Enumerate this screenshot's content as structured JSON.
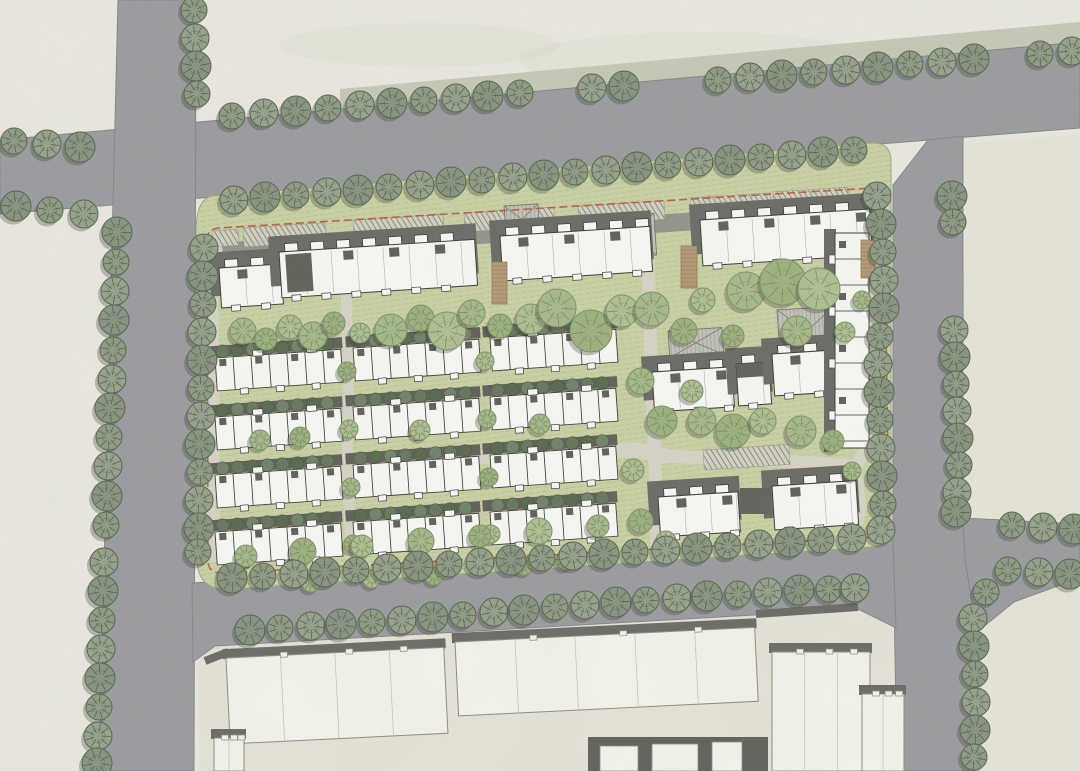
{
  "meta": {
    "title": "Residential site plan rendering",
    "canvas": {
      "w": 1080,
      "h": 771
    }
  },
  "palette": {
    "paper": "#edebe2",
    "verge": "#c2c5b1",
    "parcel": "#e9e6d9",
    "parcelRight": "#eae7da",
    "road": "#9c9da1",
    "roadEdge": "#85868a",
    "lawn": "#ccd4a6",
    "lawnEdge": "#9aa77e",
    "lawnHatch": "#a9b77e",
    "innerLight": "#d9d6c8",
    "innerGray": "#96958c",
    "red": "#c0523c",
    "white": "#fbfbf8",
    "line": "#3a3a38",
    "shadow": "#6b6b66",
    "rowShadow": "#61615a",
    "darkUnit": "#5f6158",
    "darkBlock": "#62625c",
    "outlineFill": "#f7f6ef",
    "outlineLine": "#8e8e84",
    "gableFill": "#c4c3ba",
    "gableLine": "#6f6f68",
    "tan": "#b79b74",
    "tanLine": "#8a7452",
    "parkFill": "#d6d4c6",
    "parkLine": "#82857b",
    "blotch": "#8a9478"
  },
  "roads": {
    "top": [
      [
        0,
        140
      ],
      [
        1080,
        42
      ],
      [
        1080,
        128
      ],
      [
        0,
        214
      ]
    ],
    "left": [
      [
        118,
        0
      ],
      [
        196,
        0
      ],
      [
        194,
        771
      ],
      [
        99,
        771
      ]
    ],
    "right": [
      [
        893,
        185
      ],
      [
        928,
        140
      ],
      [
        963,
        136
      ],
      [
        963,
        515
      ],
      [
        977,
        640
      ],
      [
        975,
        771
      ],
      [
        897,
        771
      ],
      [
        893,
        545
      ]
    ],
    "eastSt": [
      [
        963,
        518
      ],
      [
        1080,
        524
      ],
      [
        1080,
        578
      ],
      [
        1014,
        602
      ],
      [
        977,
        632
      ],
      [
        965,
        560
      ]
    ],
    "bottom": [
      [
        192,
        583
      ],
      [
        870,
        542
      ],
      [
        893,
        540
      ],
      [
        896,
        628
      ],
      [
        858,
        609
      ],
      [
        215,
        646
      ],
      [
        193,
        662
      ]
    ]
  },
  "verge": [
    [
      340,
      89
    ],
    [
      1080,
      22
    ],
    [
      1080,
      44
    ],
    [
      340,
      111
    ]
  ],
  "parcels": [
    {
      "name": "block-northeast",
      "d": "M965,144 L1080,134 L1080,524 L996,524 Q965,524 965,493 Z",
      "fill": "parcelRight"
    },
    {
      "name": "block-southeast",
      "d": "M977,771 L977,650 Q977,612 1014,604 L1080,578 L1080,771 Z",
      "fill": "parcelRight"
    },
    {
      "name": "block-south",
      "d": "M200,771 L197,667 Q196,648 216,646 L850,608 Q886,604 893,628 L897,771 Z",
      "fill": "parcel"
    }
  ],
  "site": {
    "lawn": "M212,196 L872,143 Q891,142 891,162 L891,527 Q891,545 872,547 L232,589 Q198,592 197,560 L196,232 Q196,199 212,196 Z",
    "boundary": "M207,240 Q207,229 219,228 L872,188 Q884,187 884,197 L889,524 Q889,535 877,537 L224,573 Q209,574 208,562 Z",
    "boundaryDash": "8 4"
  },
  "innerRoads": [
    {
      "pts": [
        [
          214,
          252
        ],
        [
          870,
          210
        ]
      ],
      "w": 18,
      "c": "gray"
    },
    {
      "pts": [
        [
          216,
          250
        ],
        [
          212,
          300
        ],
        [
          214,
          556
        ]
      ],
      "w": 13,
      "c": "light"
    },
    {
      "pts": [
        [
          206,
          470
        ],
        [
          636,
          450
        ],
        [
          666,
          456
        ]
      ],
      "w": 15,
      "c": "light"
    },
    {
      "pts": [
        [
          345,
          258
        ],
        [
          349,
          402
        ],
        [
          347,
          448
        ],
        [
          351,
          556
        ]
      ],
      "w": 11,
      "c": "light"
    },
    {
      "pts": [
        [
          648,
          253
        ],
        [
          652,
          402
        ],
        [
          655,
          453
        ],
        [
          657,
          553
        ]
      ],
      "w": 13,
      "c": "light"
    },
    {
      "pts": [
        [
          870,
          219
        ],
        [
          876,
          340
        ],
        [
          876,
          430
        ],
        [
          856,
          466
        ],
        [
          800,
          462
        ],
        [
          666,
          456
        ]
      ],
      "w": 13,
      "c": "light"
    },
    {
      "pts": [
        [
          856,
          466
        ],
        [
          862,
          508
        ],
        [
          851,
          548
        ]
      ],
      "w": 10,
      "c": "light"
    }
  ],
  "parking": {
    "rot": -3.7,
    "strips": [
      [
        212,
        231,
        26,
        16
      ],
      [
        243,
        228,
        82,
        19
      ],
      [
        353,
        220,
        90,
        19
      ],
      [
        464,
        213,
        90,
        19
      ],
      [
        578,
        206,
        86,
        19
      ],
      [
        690,
        198,
        80,
        18
      ],
      [
        773,
        192,
        75,
        18
      ],
      [
        703,
        450,
        86,
        20
      ]
    ]
  },
  "pergolas": [
    [
      492,
      262,
      15,
      42
    ],
    [
      681,
      246,
      16,
      42
    ],
    [
      861,
      240,
      14,
      38
    ]
  ],
  "gables": {
    "rot": -3.7,
    "list": [
      [
        777,
        310,
        57,
        46
      ],
      [
        668,
        331,
        54,
        27
      ],
      [
        609,
        216,
        45,
        42
      ],
      [
        504,
        206,
        34,
        29
      ]
    ]
  },
  "slabs": [
    {
      "x": 219,
      "y": 268,
      "w": 62,
      "h": 40,
      "rot": -3.7
    },
    {
      "x": 279,
      "y": 252,
      "w": 196,
      "h": 46,
      "rot": -3.7,
      "darkEnd": true
    },
    {
      "x": 500,
      "y": 236,
      "w": 150,
      "h": 45,
      "rot": -3.7
    },
    {
      "x": 700,
      "y": 220,
      "w": 170,
      "h": 46,
      "rot": -3.7
    }
  ],
  "blocks": [
    {
      "x": 652,
      "y": 372,
      "w": 80,
      "h": 40,
      "rot": -3.7
    },
    {
      "x": 736,
      "y": 364,
      "w": 33,
      "h": 42,
      "rot": -3.7,
      "darkTop": true
    },
    {
      "x": 772,
      "y": 354,
      "w": 80,
      "h": 42,
      "rot": -3.7
    },
    {
      "x": 658,
      "y": 497,
      "w": 80,
      "h": 40,
      "rot": -3.7
    },
    {
      "x": 772,
      "y": 486,
      "w": 84,
      "h": 44,
      "rot": -3.7
    }
  ],
  "connector": {
    "x": 740,
    "y": 488,
    "w": 31,
    "h": 26
  },
  "strip": {
    "x": 835,
    "y": 233,
    "w": 34,
    "h": 215
  },
  "rows": {
    "w": 126,
    "h": 33,
    "rot": -4,
    "cols": [
      {
        "x": 215,
        "ys": [
          358,
          417,
          475,
          532
        ]
      },
      {
        "x": 353,
        "ys": [
          348,
          407,
          465,
          522
        ]
      },
      {
        "x": 490,
        "ys": [
          338,
          397,
          455,
          512
        ]
      }
    ]
  },
  "outlines": [
    {
      "x": 226,
      "y": 658,
      "w": 218,
      "h": 86,
      "rot": -2.8,
      "steps": 3
    },
    {
      "x": 455,
      "y": 642,
      "w": 300,
      "h": 74,
      "rot": -2.8,
      "steps": 4
    },
    {
      "x": 772,
      "y": 652,
      "w": 98,
      "h": 119,
      "rot": 0,
      "steps": 2
    },
    {
      "x": 214,
      "y": 738,
      "w": 30,
      "h": 33,
      "rot": 0,
      "steps": 1
    },
    {
      "x": 862,
      "y": 694,
      "w": 42,
      "h": 77,
      "rot": 0,
      "steps": 1
    }
  ],
  "darkBlock": {
    "x": 588,
    "y": 737,
    "w": 180,
    "h": 34,
    "insets": [
      [
        600,
        746,
        38,
        25
      ],
      [
        652,
        744,
        46,
        27
      ],
      [
        712,
        742,
        30,
        29
      ]
    ]
  },
  "walls": [
    [
      [
        205,
        661
      ],
      [
        228,
        652
      ]
    ],
    [
      [
        756,
        614
      ],
      [
        858,
        607
      ]
    ]
  ],
  "trees": {
    "street": [
      [
        14,
        141
      ],
      [
        47,
        144
      ],
      [
        80,
        147
      ],
      [
        232,
        116
      ],
      [
        264,
        113
      ],
      [
        296,
        111
      ],
      [
        328,
        108
      ],
      [
        360,
        105
      ],
      [
        392,
        103
      ],
      [
        424,
        100
      ],
      [
        456,
        98
      ],
      [
        488,
        96
      ],
      [
        520,
        93
      ],
      [
        592,
        88
      ],
      [
        624,
        86
      ],
      [
        718,
        80
      ],
      [
        750,
        77
      ],
      [
        782,
        75
      ],
      [
        814,
        72
      ],
      [
        846,
        70
      ],
      [
        878,
        67
      ],
      [
        910,
        64
      ],
      [
        942,
        62
      ],
      [
        974,
        59
      ],
      [
        1040,
        54
      ],
      [
        1072,
        51
      ],
      [
        16,
        206
      ],
      [
        50,
        210
      ],
      [
        84,
        214
      ],
      [
        117,
        232
      ],
      [
        116,
        262
      ],
      [
        115,
        291
      ],
      [
        114,
        320
      ],
      [
        113,
        350
      ],
      [
        112,
        379
      ],
      [
        110,
        408
      ],
      [
        109,
        437
      ],
      [
        108,
        466
      ],
      [
        107,
        496
      ],
      [
        106,
        525
      ],
      [
        104,
        562
      ],
      [
        103,
        591
      ],
      [
        102,
        620
      ],
      [
        101,
        649
      ],
      [
        100,
        678
      ],
      [
        99,
        707
      ],
      [
        98,
        736
      ],
      [
        97,
        763
      ],
      [
        194,
        10
      ],
      [
        195,
        38
      ],
      [
        196,
        66
      ],
      [
        197,
        94
      ],
      [
        234,
        200
      ],
      [
        265,
        197
      ],
      [
        296,
        195
      ],
      [
        327,
        192
      ],
      [
        358,
        190
      ],
      [
        389,
        187
      ],
      [
        420,
        185
      ],
      [
        451,
        182
      ],
      [
        482,
        180
      ],
      [
        513,
        177
      ],
      [
        544,
        175
      ],
      [
        575,
        172
      ],
      [
        606,
        170
      ],
      [
        637,
        167
      ],
      [
        668,
        165
      ],
      [
        699,
        162
      ],
      [
        730,
        160
      ],
      [
        761,
        157
      ],
      [
        792,
        155
      ],
      [
        823,
        152
      ],
      [
        854,
        150
      ],
      [
        204,
        248
      ],
      [
        203,
        276
      ],
      [
        203,
        304
      ],
      [
        202,
        332
      ],
      [
        202,
        360
      ],
      [
        201,
        388
      ],
      [
        201,
        416
      ],
      [
        200,
        444
      ],
      [
        200,
        472
      ],
      [
        199,
        500
      ],
      [
        199,
        528
      ],
      [
        198,
        552
      ],
      [
        877,
        196
      ],
      [
        881,
        224
      ],
      [
        883,
        252
      ],
      [
        884,
        280
      ],
      [
        884,
        308
      ],
      [
        880,
        336
      ],
      [
        878,
        364
      ],
      [
        879,
        392
      ],
      [
        880,
        420
      ],
      [
        881,
        448
      ],
      [
        882,
        476
      ],
      [
        883,
        504
      ],
      [
        881,
        530
      ],
      [
        232,
        578
      ],
      [
        263,
        576
      ],
      [
        294,
        574
      ],
      [
        325,
        572
      ],
      [
        356,
        570
      ],
      [
        387,
        568
      ],
      [
        418,
        566
      ],
      [
        449,
        564
      ],
      [
        480,
        562
      ],
      [
        511,
        560
      ],
      [
        542,
        558
      ],
      [
        573,
        556
      ],
      [
        604,
        554
      ],
      [
        635,
        552
      ],
      [
        666,
        550
      ],
      [
        697,
        548
      ],
      [
        728,
        546
      ],
      [
        759,
        544
      ],
      [
        790,
        542
      ],
      [
        821,
        540
      ],
      [
        852,
        538
      ],
      [
        250,
        630
      ],
      [
        280,
        628
      ],
      [
        311,
        626
      ],
      [
        341,
        624
      ],
      [
        372,
        622
      ],
      [
        402,
        620
      ],
      [
        433,
        617
      ],
      [
        463,
        615
      ],
      [
        494,
        612
      ],
      [
        524,
        610
      ],
      [
        555,
        607
      ],
      [
        585,
        605
      ],
      [
        616,
        602
      ],
      [
        646,
        600
      ],
      [
        677,
        598
      ],
      [
        707,
        596
      ],
      [
        738,
        594
      ],
      [
        768,
        592
      ],
      [
        799,
        590
      ],
      [
        829,
        589
      ],
      [
        855,
        588
      ],
      [
        952,
        196
      ],
      [
        953,
        222
      ],
      [
        954,
        330
      ],
      [
        955,
        357
      ],
      [
        956,
        384
      ],
      [
        957,
        411
      ],
      [
        958,
        438
      ],
      [
        959,
        465
      ],
      [
        957,
        492
      ],
      [
        956,
        512
      ],
      [
        1012,
        525
      ],
      [
        1043,
        527
      ],
      [
        1074,
        529
      ],
      [
        1008,
        570
      ],
      [
        1039,
        572
      ],
      [
        1070,
        574
      ],
      [
        986,
        592
      ],
      [
        973,
        618
      ],
      [
        974,
        646
      ],
      [
        975,
        674
      ],
      [
        976,
        702
      ],
      [
        975,
        730
      ],
      [
        974,
        757
      ]
    ],
    "site": [
      [
        243,
        331,
        13
      ],
      [
        266,
        339,
        11
      ],
      [
        290,
        327,
        12
      ],
      [
        313,
        336,
        14
      ],
      [
        334,
        323,
        11
      ],
      [
        360,
        333,
        10
      ],
      [
        391,
        330,
        16
      ],
      [
        421,
        318,
        13
      ],
      [
        447,
        331,
        19
      ],
      [
        472,
        313,
        13
      ],
      [
        500,
        326,
        12
      ],
      [
        531,
        319,
        15
      ],
      [
        557,
        308,
        19
      ],
      [
        591,
        331,
        21
      ],
      [
        622,
        311,
        16
      ],
      [
        652,
        309,
        17
      ],
      [
        684,
        331,
        13
      ],
      [
        703,
        300,
        12
      ],
      [
        746,
        291,
        19
      ],
      [
        783,
        282,
        23
      ],
      [
        819,
        289,
        21
      ],
      [
        797,
        331,
        15
      ],
      [
        733,
        336,
        11
      ],
      [
        845,
        332,
        10
      ],
      [
        862,
        300,
        9
      ],
      [
        347,
        371,
        9
      ],
      [
        349,
        429,
        9
      ],
      [
        351,
        487,
        9
      ],
      [
        353,
        544,
        9
      ],
      [
        485,
        361,
        9
      ],
      [
        487,
        419,
        9
      ],
      [
        489,
        477,
        9
      ],
      [
        491,
        534,
        9
      ],
      [
        641,
        381,
        13
      ],
      [
        662,
        421,
        15
      ],
      [
        633,
        470,
        11
      ],
      [
        702,
        421,
        14
      ],
      [
        733,
        431,
        17
      ],
      [
        763,
        421,
        13
      ],
      [
        801,
        431,
        15
      ],
      [
        833,
        441,
        11
      ],
      [
        692,
        391,
        11
      ],
      [
        852,
        471,
        9
      ],
      [
        641,
        521,
        12
      ],
      [
        666,
        541,
        10
      ],
      [
        246,
        556,
        11
      ],
      [
        303,
        551,
        13
      ],
      [
        362,
        546,
        11
      ],
      [
        421,
        541,
        13
      ],
      [
        480,
        536,
        11
      ],
      [
        539,
        531,
        13
      ],
      [
        598,
        526,
        11
      ],
      [
        434,
        576,
        9
      ],
      [
        372,
        579,
        9
      ],
      [
        311,
        583,
        9
      ],
      [
        524,
        566,
        9
      ],
      [
        565,
        561,
        9
      ],
      [
        260,
        440,
        10
      ],
      [
        300,
        437,
        10
      ],
      [
        420,
        430,
        10
      ],
      [
        540,
        424,
        10
      ]
    ]
  },
  "blotches": [
    [
      700,
      60,
      180,
      28
    ],
    [
      420,
      45,
      140,
      22
    ],
    [
      960,
      95,
      120,
      20
    ],
    [
      1020,
      300,
      60,
      90
    ],
    [
      600,
      700,
      160,
      40
    ]
  ]
}
